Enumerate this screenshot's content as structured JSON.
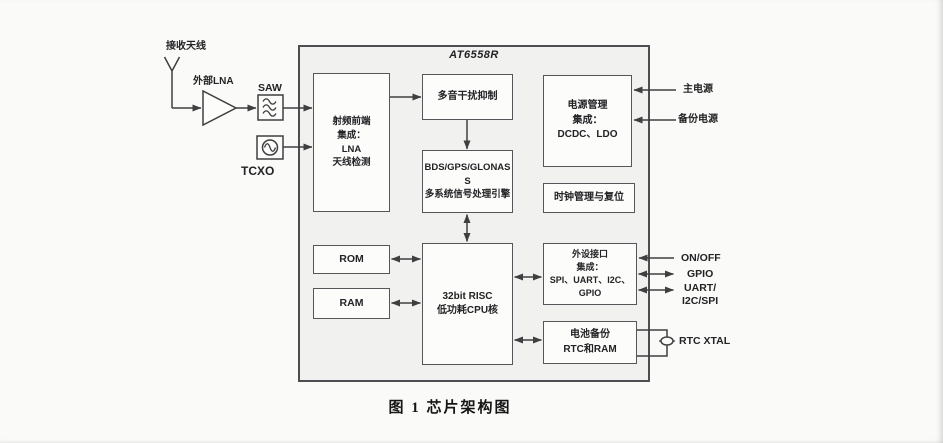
{
  "chip": {
    "title": "AT6558R"
  },
  "caption": "图 1 芯片架构图",
  "external_left": {
    "antenna_label": "接收天线",
    "lna_label": "外部LNA",
    "saw_label": "SAW",
    "tcxo_label": "TCXO"
  },
  "blocks": {
    "rf_frontend": {
      "lines": [
        "射频前端",
        "集成：",
        "LNA",
        "天线检测"
      ]
    },
    "multitone": {
      "lines": [
        "多音干扰抑制"
      ]
    },
    "power_mgmt": {
      "lines": [
        "电源管理",
        "集成：",
        "DCDC、LDO"
      ]
    },
    "bds_engine": {
      "lines": [
        "BDS/GPS/GLONAS",
        "S",
        "多系统信号处理引擎"
      ]
    },
    "clock_reset": {
      "lines": [
        "时钟管理与复位"
      ]
    },
    "rom": {
      "lines": [
        "ROM"
      ]
    },
    "ram": {
      "lines": [
        "RAM"
      ]
    },
    "cpu": {
      "lines": [
        "32bit RISC",
        "低功耗CPU核"
      ]
    },
    "peripheral": {
      "lines": [
        "外设接口",
        "集成：",
        "SPI、UART、I2C、",
        "GPIO"
      ]
    },
    "battery": {
      "lines": [
        "电池备份",
        "RTC和RAM"
      ]
    }
  },
  "external_right": {
    "main_power": "主电源",
    "backup_power": "备份电源",
    "on_off": "ON/OFF",
    "gpio": "GPIO",
    "uart_line1": "UART/",
    "uart_line2": "I2C/SPI",
    "rtc_xtal": "RTC XTAL"
  },
  "colors": {
    "page_bg": "#fafaf8",
    "chip_fill": "#f1f1ef",
    "block_fill": "#fcfcfb",
    "block_border": "#55555a",
    "wire": "#3f3f41",
    "text": "#232326"
  }
}
